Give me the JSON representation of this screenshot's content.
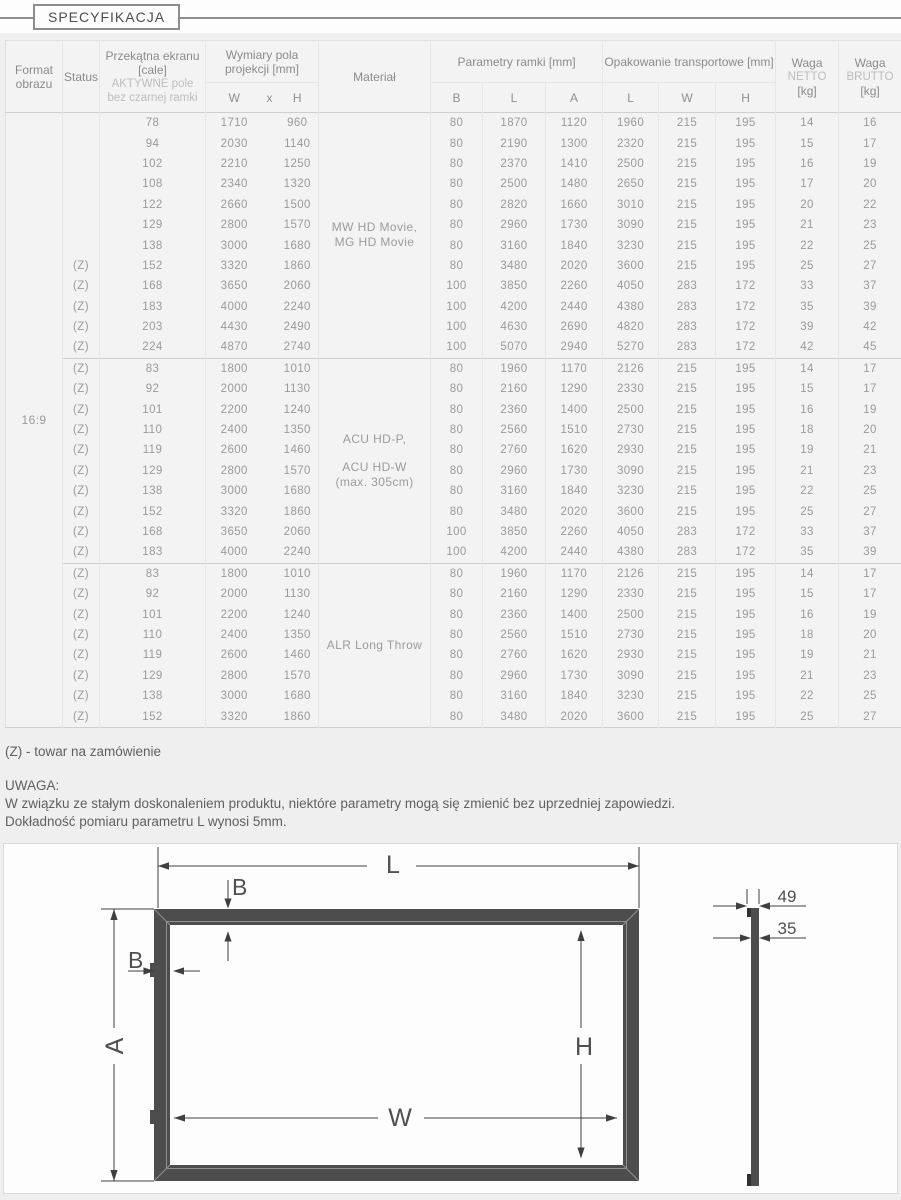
{
  "header": {
    "title": "SPECYFIKACJA"
  },
  "table": {
    "headers": {
      "format": "Format obrazu",
      "status": "Status",
      "diag_title": "Przekątna ekranu [cale]",
      "diag_sub": "AKTYWNE pole bez czarnej ramki",
      "dims": "Wymiary pola projekcji [mm]",
      "dims_sub": [
        "W",
        "x",
        "H"
      ],
      "material": "Materiał",
      "frame": "Parametry ramki [mm]",
      "frame_sub": [
        "B",
        "L",
        "A"
      ],
      "packaging": "Opakowanie transportowe [mm]",
      "packaging_sub": [
        "L",
        "W",
        "H"
      ],
      "weight_net": [
        "Waga",
        "NETTO",
        "[kg]"
      ],
      "weight_gross": [
        "Waga",
        "BRUTTO",
        "[kg]"
      ]
    },
    "format_value": "16:9",
    "groups": [
      {
        "material_lines": [
          "MW HD Movie,",
          "MG HD Movie"
        ],
        "rows": [
          [
            "",
            78,
            1710,
            960,
            80,
            1870,
            1120,
            1960,
            215,
            195,
            14,
            16
          ],
          [
            "",
            94,
            2030,
            1140,
            80,
            2190,
            1300,
            2320,
            215,
            195,
            15,
            17
          ],
          [
            "",
            102,
            2210,
            1250,
            80,
            2370,
            1410,
            2500,
            215,
            195,
            16,
            19
          ],
          [
            "",
            108,
            2340,
            1320,
            80,
            2500,
            1480,
            2650,
            215,
            195,
            17,
            20
          ],
          [
            "",
            122,
            2660,
            1500,
            80,
            2820,
            1660,
            3010,
            215,
            195,
            20,
            22
          ],
          [
            "",
            129,
            2800,
            1570,
            80,
            2960,
            1730,
            3090,
            215,
            195,
            21,
            23
          ],
          [
            "",
            138,
            3000,
            1680,
            80,
            3160,
            1840,
            3230,
            215,
            195,
            22,
            25
          ],
          [
            "(Z)",
            152,
            3320,
            1860,
            80,
            3480,
            2020,
            3600,
            215,
            195,
            25,
            27
          ],
          [
            "(Z)",
            168,
            3650,
            2060,
            100,
            3850,
            2260,
            4050,
            283,
            172,
            33,
            37
          ],
          [
            "(Z)",
            183,
            4000,
            2240,
            100,
            4200,
            2440,
            4380,
            283,
            172,
            35,
            39
          ],
          [
            "(Z)",
            203,
            4430,
            2490,
            100,
            4630,
            2690,
            4820,
            283,
            172,
            39,
            42
          ],
          [
            "(Z)",
            224,
            4870,
            2740,
            100,
            5070,
            2940,
            5270,
            283,
            172,
            42,
            45
          ]
        ]
      },
      {
        "material_lines": [
          "ACU HD-P,",
          "",
          "ACU HD-W",
          "(max. 305cm)"
        ],
        "rows": [
          [
            "(Z)",
            83,
            1800,
            1010,
            80,
            1960,
            1170,
            2126,
            215,
            195,
            14,
            17
          ],
          [
            "(Z)",
            92,
            2000,
            1130,
            80,
            2160,
            1290,
            2330,
            215,
            195,
            15,
            17
          ],
          [
            "(Z)",
            101,
            2200,
            1240,
            80,
            2360,
            1400,
            2500,
            215,
            195,
            16,
            19
          ],
          [
            "(Z)",
            110,
            2400,
            1350,
            80,
            2560,
            1510,
            2730,
            215,
            195,
            18,
            20
          ],
          [
            "(Z)",
            119,
            2600,
            1460,
            80,
            2760,
            1620,
            2930,
            215,
            195,
            19,
            21
          ],
          [
            "(Z)",
            129,
            2800,
            1570,
            80,
            2960,
            1730,
            3090,
            215,
            195,
            21,
            23
          ],
          [
            "(Z)",
            138,
            3000,
            1680,
            80,
            3160,
            1840,
            3230,
            215,
            195,
            22,
            25
          ],
          [
            "(Z)",
            152,
            3320,
            1860,
            80,
            3480,
            2020,
            3600,
            215,
            195,
            25,
            27
          ],
          [
            "(Z)",
            168,
            3650,
            2060,
            100,
            3850,
            2260,
            4050,
            283,
            172,
            33,
            37
          ],
          [
            "(Z)",
            183,
            4000,
            2240,
            100,
            4200,
            2440,
            4380,
            283,
            172,
            35,
            39
          ]
        ]
      },
      {
        "material_lines": [
          "ALR Long Throw"
        ],
        "rows": [
          [
            "(Z)",
            83,
            1800,
            1010,
            80,
            1960,
            1170,
            2126,
            215,
            195,
            14,
            17
          ],
          [
            "(Z)",
            92,
            2000,
            1130,
            80,
            2160,
            1290,
            2330,
            215,
            195,
            15,
            17
          ],
          [
            "(Z)",
            101,
            2200,
            1240,
            80,
            2360,
            1400,
            2500,
            215,
            195,
            16,
            19
          ],
          [
            "(Z)",
            110,
            2400,
            1350,
            80,
            2560,
            1510,
            2730,
            215,
            195,
            18,
            20
          ],
          [
            "(Z)",
            119,
            2600,
            1460,
            80,
            2760,
            1620,
            2930,
            215,
            195,
            19,
            21
          ],
          [
            "(Z)",
            129,
            2800,
            1570,
            80,
            2960,
            1730,
            3090,
            215,
            195,
            21,
            23
          ],
          [
            "(Z)",
            138,
            3000,
            1680,
            80,
            3160,
            1840,
            3230,
            215,
            195,
            22,
            25
          ],
          [
            "(Z)",
            152,
            3320,
            1860,
            80,
            3480,
            2020,
            3600,
            215,
            195,
            25,
            27
          ]
        ]
      }
    ]
  },
  "notes": {
    "z": "(Z) - towar na zamówienie",
    "uwaga_title": "UWAGA:",
    "uwaga_line1": "W związku ze stałym doskonaleniem produktu, niektóre parametry mogą się zmienić bez uprzedniej zapowiedzi.",
    "uwaga_line2": "Dokładność pomiaru parametru L wynosi 5mm."
  },
  "diagram": {
    "label_l": "L",
    "label_b_top": "B",
    "label_b_left": "B",
    "label_a": "A",
    "label_w": "W",
    "label_h": "H",
    "depth_total": "49",
    "depth_frame": "35"
  }
}
